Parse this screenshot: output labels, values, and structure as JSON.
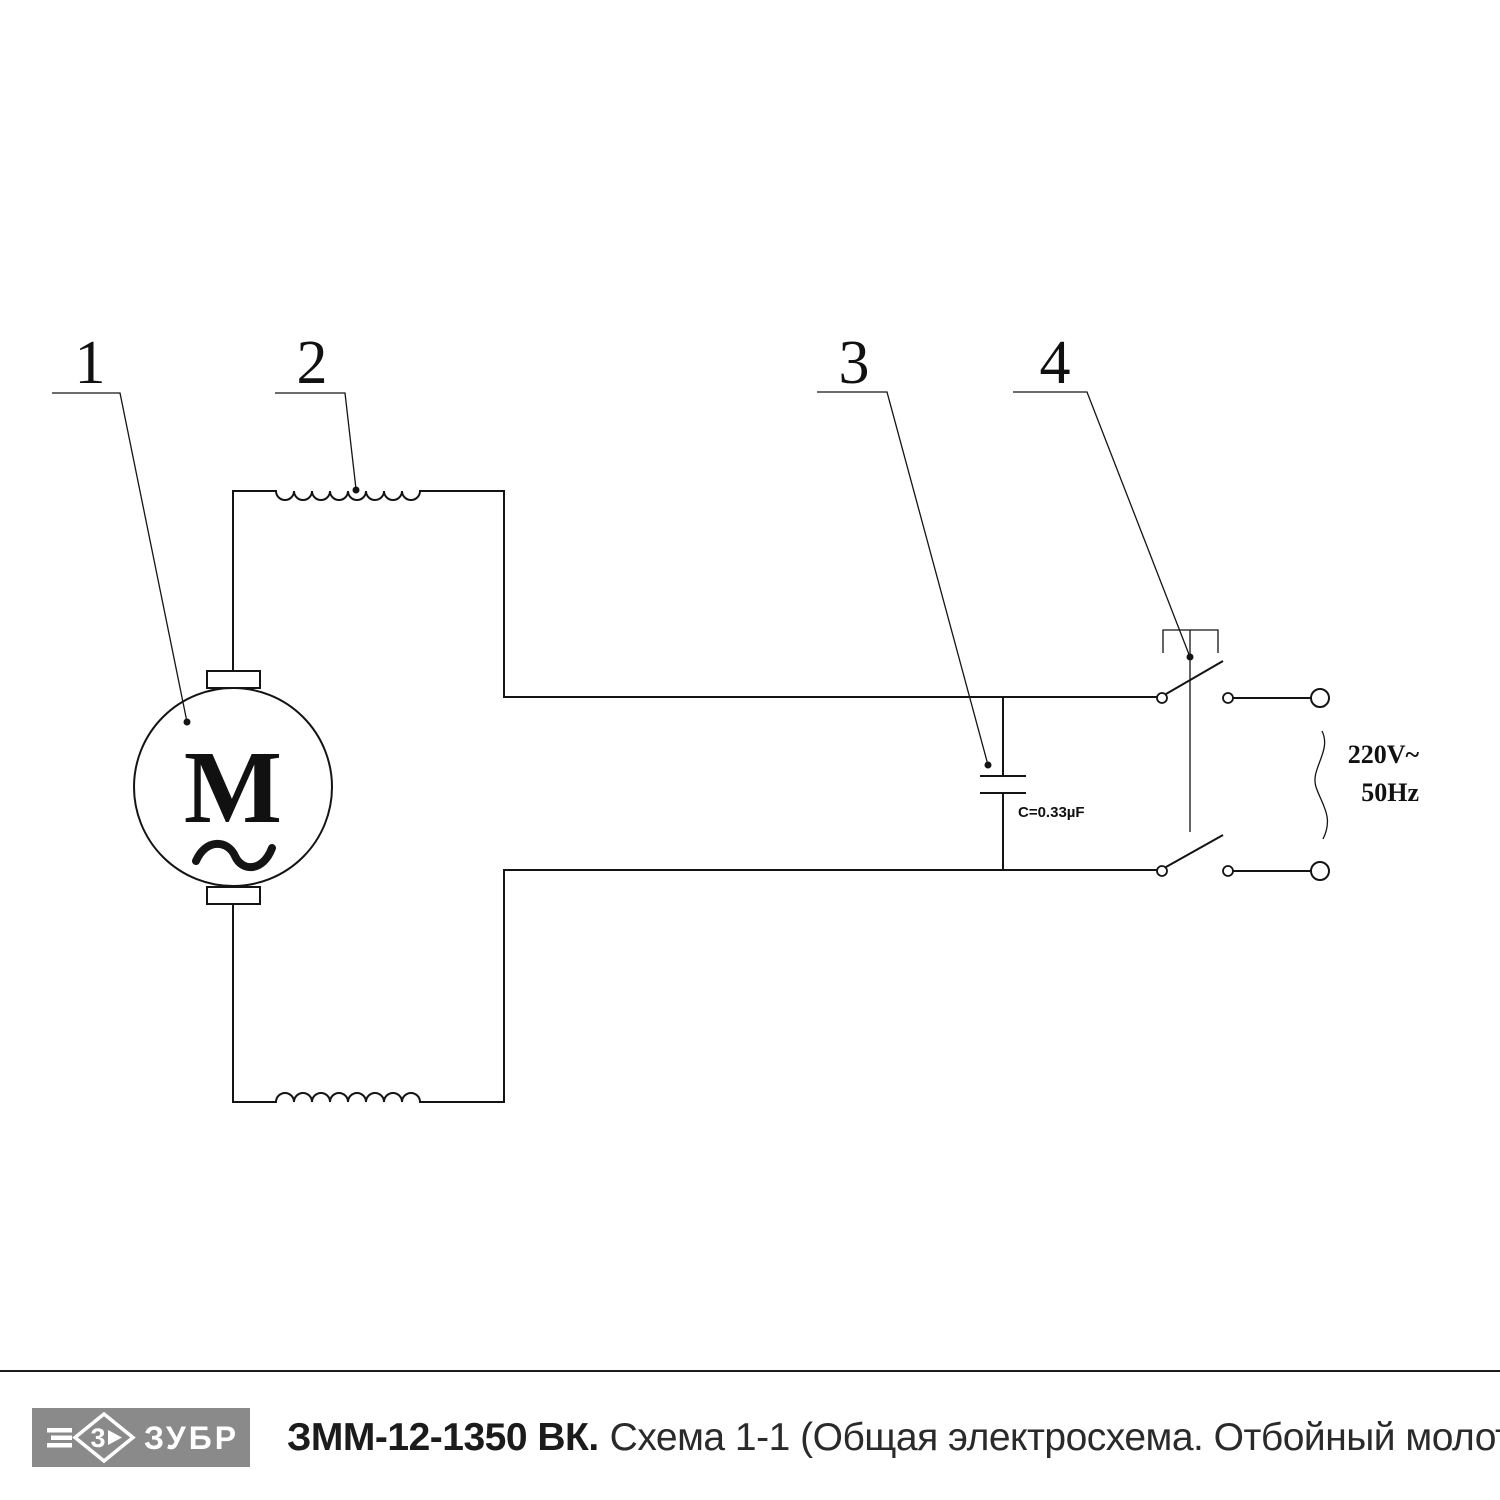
{
  "page": {
    "background": "#ffffff",
    "line_color": "#141414"
  },
  "schematic": {
    "callouts": [
      {
        "num": "1"
      },
      {
        "num": "2"
      },
      {
        "num": "3"
      },
      {
        "num": "4"
      }
    ],
    "motor": {
      "letter": "M",
      "ac_symbol": "~"
    },
    "capacitor": {
      "label": "C=0.33µF"
    },
    "supply": {
      "voltage": "220V~",
      "frequency": "50Hz"
    }
  },
  "footer": {
    "brand": "ЗУБР",
    "logo_mark": "3",
    "logo_bg": "#8a8a8a",
    "model": "ЗММ-12-1350 ВК.",
    "subtitle": "Схема 1-1 (Общая электросхема. Отбойный молоток)"
  }
}
